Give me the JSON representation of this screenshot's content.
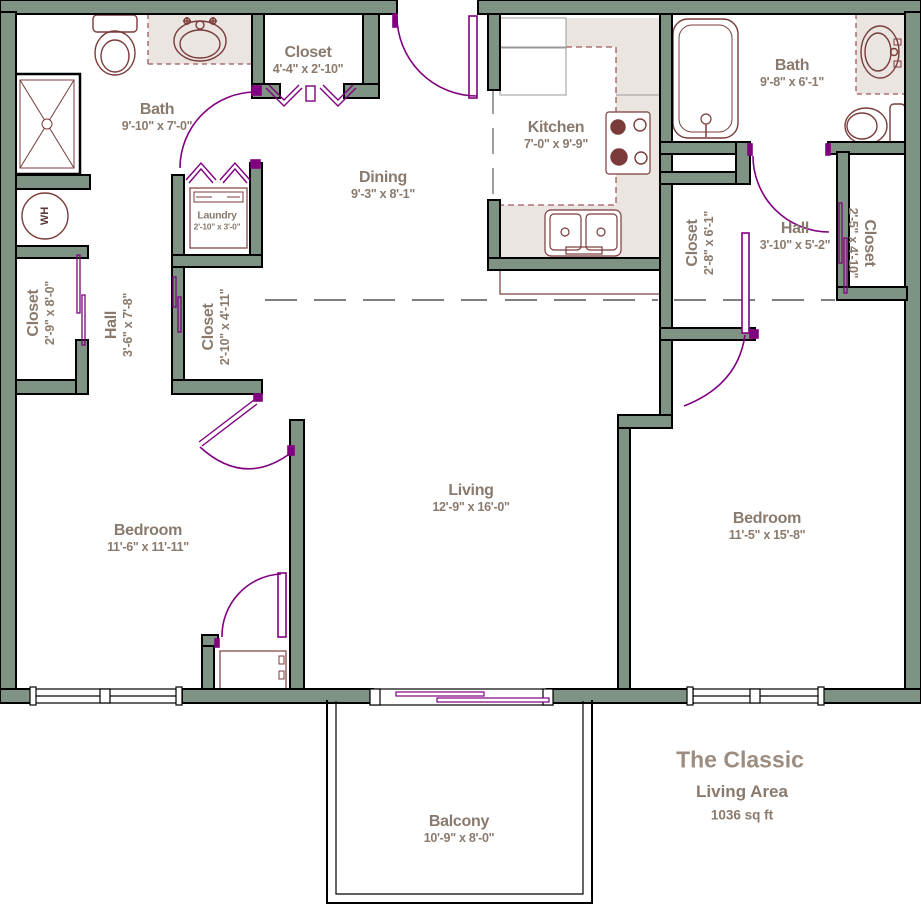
{
  "title_block": {
    "plan_name": "The Classic",
    "area_label": "Living Area",
    "area_value": "1036 sq ft"
  },
  "rooms": [
    {
      "id": "bath-left",
      "name": "Bath",
      "dims": "9'-10\" x 7'-0\""
    },
    {
      "id": "closet-top",
      "name": "Closet",
      "dims": "4'-4\" x 2'-10\""
    },
    {
      "id": "dining",
      "name": "Dining",
      "dims": "9'-3\" x 8'-1\""
    },
    {
      "id": "kitchen",
      "name": "Kitchen",
      "dims": "7'-0\" x 9'-9\""
    },
    {
      "id": "bath-right",
      "name": "Bath",
      "dims": "9'-8\" x 6'-1\""
    },
    {
      "id": "laundry",
      "name": "Laundry",
      "dims": "2'-10\" x 3'-0\""
    },
    {
      "id": "closet-left",
      "name": "Closet",
      "dims": "2'-9\" x 8'-0\""
    },
    {
      "id": "hall-left",
      "name": "Hall",
      "dims": "3'-6\" x 7'-8\""
    },
    {
      "id": "closet-mid-left",
      "name": "Closet",
      "dims": "2'-10\" x 4'-11\""
    },
    {
      "id": "closet-right",
      "name": "Closet",
      "dims": "2'-8\" x 6'-1\""
    },
    {
      "id": "hall-right",
      "name": "Hall",
      "dims": "3'-10\" x 5'-2\""
    },
    {
      "id": "closet-far-right",
      "name": "Closet",
      "dims": "2'-5\" x 4'-10\""
    },
    {
      "id": "bedroom-left",
      "name": "Bedroom",
      "dims": "11'-6\" x 11'-11\""
    },
    {
      "id": "living",
      "name": "Living",
      "dims": "12'-9\" x 16'-0\""
    },
    {
      "id": "bedroom-right",
      "name": "Bedroom",
      "dims": "11'-5\" x 15'-8\""
    },
    {
      "id": "balcony",
      "name": "Balcony",
      "dims": "10'-9\" x 8'-0\""
    }
  ],
  "fixtures": {
    "water_heater": "WH"
  },
  "colors": {
    "wall_fill": "#7E9383",
    "wall_outline": "#000000",
    "door": "#800080",
    "fixture_line": "#7B3B3B",
    "counter_fill": "#EAE5E1",
    "counter_dash": "#A05858",
    "label_text": "#8A7A6D",
    "title_text": "#9C8D80",
    "separator_dash": "#7F7F7F"
  }
}
